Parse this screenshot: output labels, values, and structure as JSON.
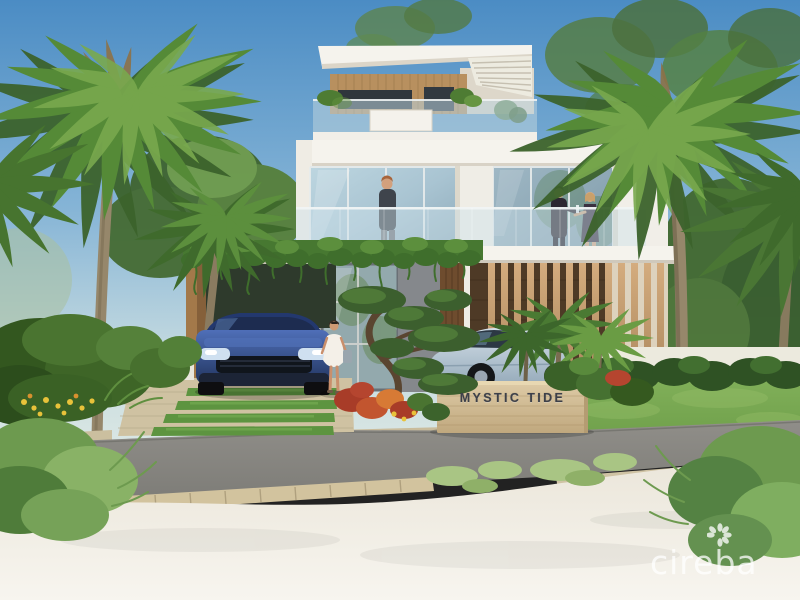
{
  "scene_type": "architectural-rendering-villa-exterior",
  "sign": {
    "label": "MYSTIC TIDE"
  },
  "watermark": {
    "brand": "cireba",
    "icon": "flower-icon"
  },
  "colors": {
    "skyTop": "#4b8cc4",
    "skyMid": "#85b4d6",
    "skyLow": "#c6dbe0",
    "sandLight": "#f7f5ef",
    "sand": "#ebe6da",
    "road": "#908e89",
    "roadDark": "#7d7c77",
    "lawn": "#6fa04b",
    "lawnLight": "#85b35c",
    "leafDark": "#3c632c",
    "leafMid": "#558a37",
    "leafLight": "#79a94e",
    "palmTrunk": "#96876b",
    "vine": "#477831",
    "wood": "#b8905f",
    "woodDark": "#8a6a44",
    "slat": "#c9a270",
    "slatDark": "#4e3a26",
    "whiteWall": "#f5f3ed",
    "whiteShadow": "#ddd7ca",
    "glass": "#a9c4d2",
    "glassDark": "#7e99a8",
    "frameGray": "#85888c",
    "suv": "#31519c",
    "suvDark": "#22355f",
    "coupe": "#b6c7d4",
    "stone": "#d4bd93",
    "stoneLight": "#e8d8b2",
    "signText": "#3d4049",
    "skin": "#d3a07c",
    "paver": "#cfc2a2",
    "curb": "#d2c39e"
  }
}
